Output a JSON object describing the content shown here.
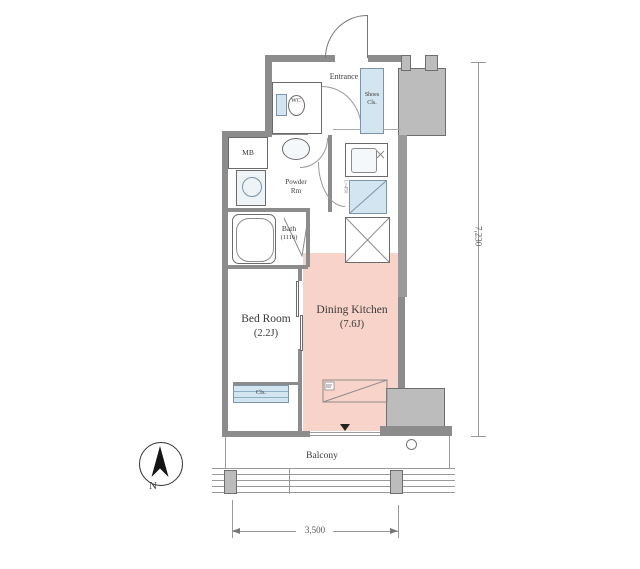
{
  "rooms": {
    "entrance": "Entrance",
    "wc": "WC",
    "shoes_closet": {
      "line1": "Shoes",
      "line2": "Cls."
    },
    "meter_box": "MB",
    "powder_room": {
      "line1": "Powder",
      "line2": "Rm"
    },
    "bath": {
      "name": "Bath",
      "size": "(1116)"
    },
    "bedroom": {
      "name": "Bed Room",
      "size": "(2.2J)"
    },
    "dining_kitchen": {
      "name": "Dining Kitchen",
      "size": "(7.6J)"
    },
    "closet": "Cls.",
    "balcony": "Balcony"
  },
  "dimensions": {
    "bottom_width_mm": "3,500",
    "right_height_mm": "7,230"
  },
  "compass": {
    "north": "N"
  },
  "annotations": {
    "kitchen_note": "L=450"
  },
  "colors": {
    "dk_fill": "#f8d3c9",
    "fixture_blue": "#d2e5f1",
    "pillar_gray": "#bcbcbc",
    "wall_gray": "#8c8c8c",
    "text": "#3a3a3a"
  }
}
